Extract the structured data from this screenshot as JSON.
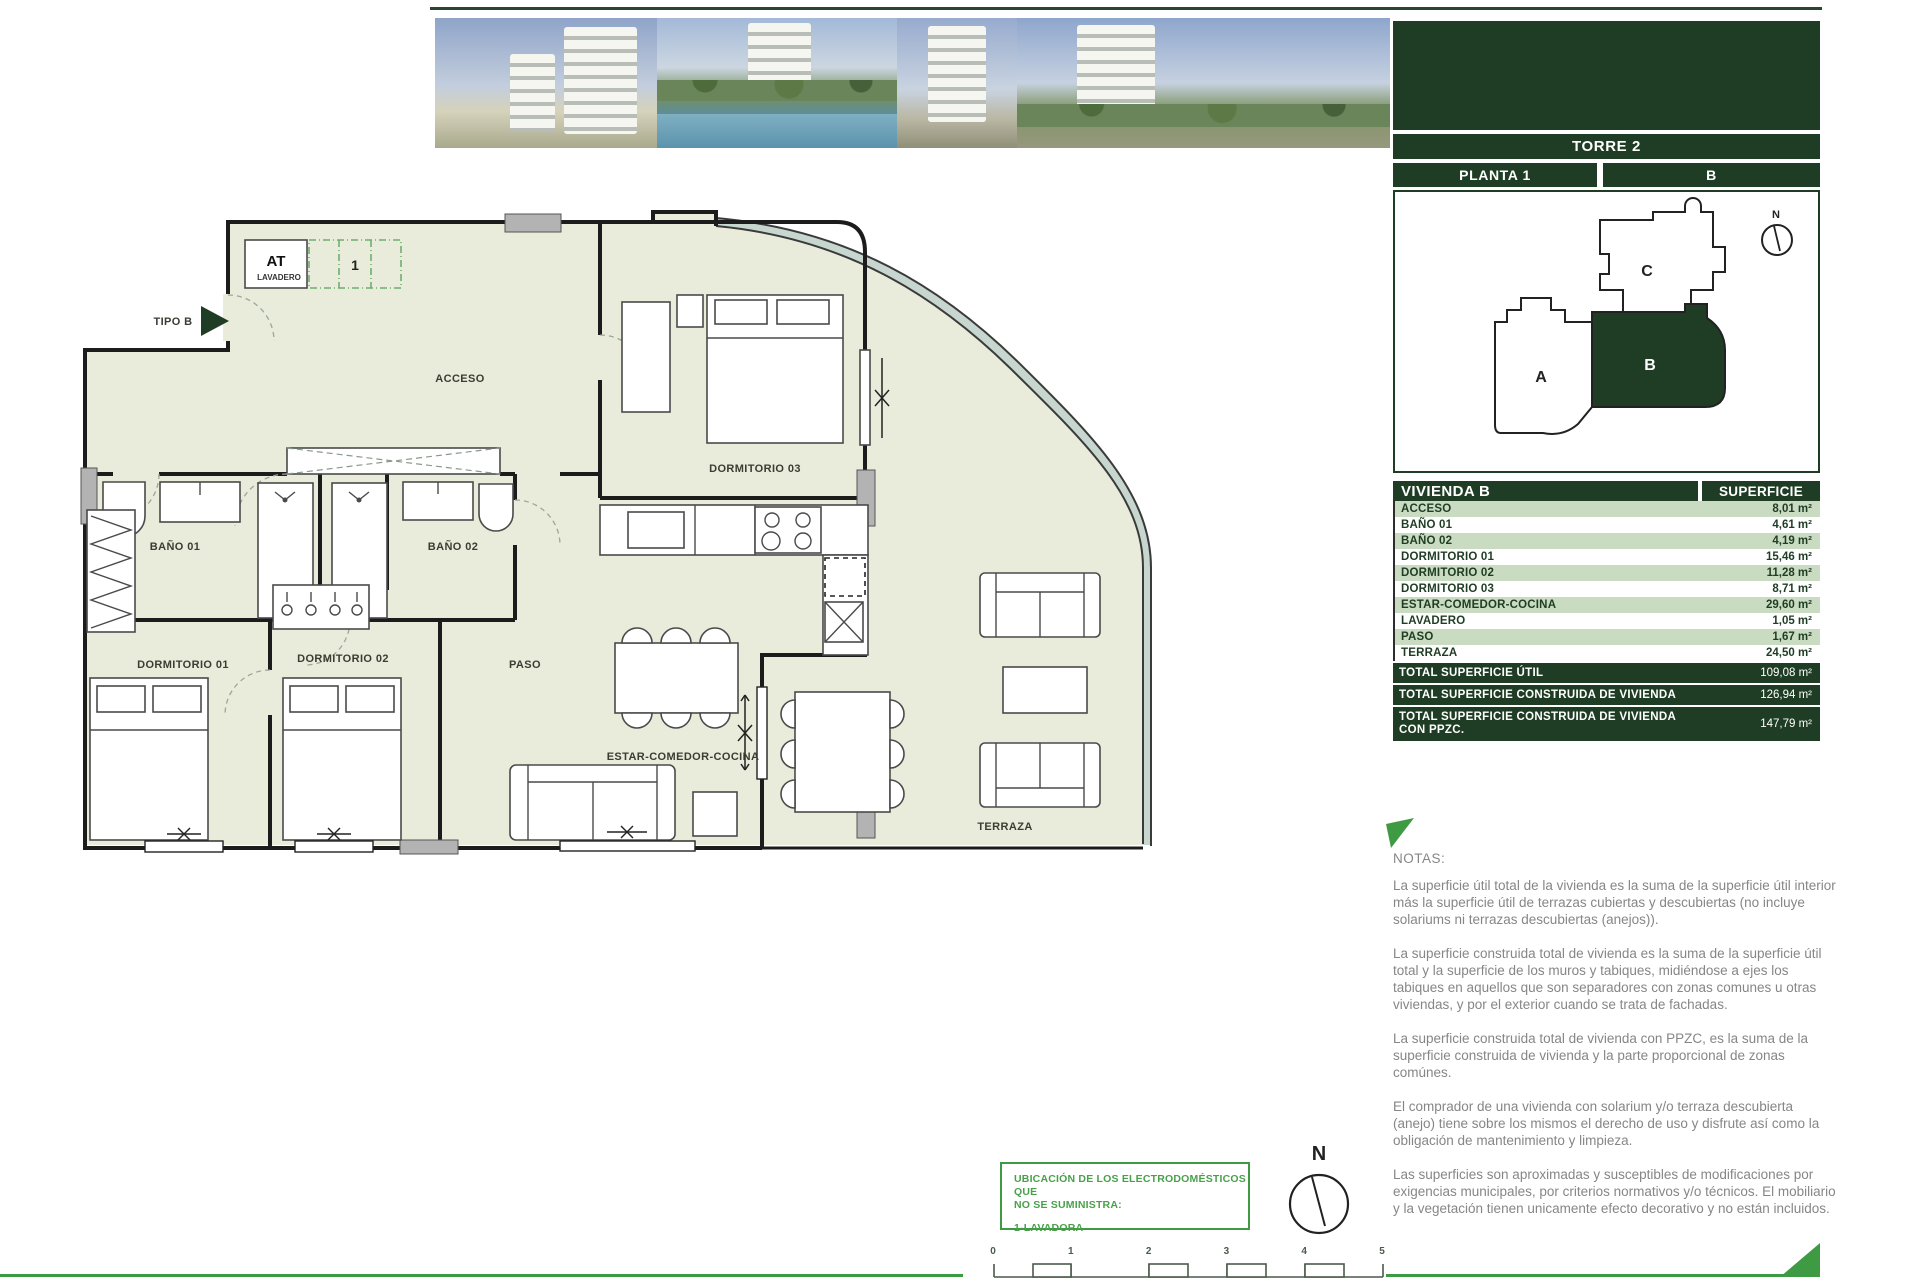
{
  "colors": {
    "dark_green": "#1f3d24",
    "row_green": "#c9dbc1",
    "accent_green": "#3f9b43",
    "floor": "#e9ecdb",
    "notes_gray": "#868686"
  },
  "header": {
    "torre": "TORRE 2",
    "planta": "PLANTA 1",
    "unit": "B"
  },
  "key_plan": {
    "unit_a": "A",
    "unit_b": "B",
    "unit_c": "C",
    "north": "N"
  },
  "area_table": {
    "title": "VIVIENDA B",
    "column": "SUPERFICIE",
    "rows": [
      {
        "label": "ACCESO",
        "value": "8,01 m²"
      },
      {
        "label": "BAÑO 01",
        "value": "4,61 m²"
      },
      {
        "label": "BAÑO 02",
        "value": "4,19 m²"
      },
      {
        "label": "DORMITORIO 01",
        "value": "15,46 m²"
      },
      {
        "label": "DORMITORIO 02",
        "value": "11,28 m²"
      },
      {
        "label": "DORMITORIO 03",
        "value": "8,71 m²"
      },
      {
        "label": "ESTAR-COMEDOR-COCINA",
        "value": "29,60 m²"
      },
      {
        "label": "LAVADERO",
        "value": "1,05 m²"
      },
      {
        "label": "PASO",
        "value": "1,67 m²"
      },
      {
        "label": "TERRAZA",
        "value": "24,50 m²"
      }
    ],
    "totals": [
      {
        "label": "TOTAL SUPERFICIE ÚTIL",
        "value": "109,08 m²",
        "lines": 1
      },
      {
        "label": "TOTAL SUPERFICIE CONSTRUIDA DE VIVIENDA",
        "value": "126,94 m²",
        "lines": 1
      },
      {
        "label": "TOTAL SUPERFICIE CONSTRUIDA DE VIVIENDA CON PPZC.",
        "value": "147,79 m²",
        "lines": 2
      }
    ]
  },
  "plan": {
    "labels": {
      "tipo": "TIPO B",
      "acceso": "ACCESO",
      "at": "AT",
      "lavadero": "LAVADERO",
      "lavadora_slot": "1",
      "dormitorio03": "DORMITORIO 03",
      "bano01": "BAÑO 01",
      "bano02": "BAÑO 02",
      "dormitorio01": "DORMITORIO 01",
      "paso": "PASO",
      "dormitorio02": "DORMITORIO 02",
      "estar": "ESTAR-COMEDOR-COCINA",
      "terraza": "TERRAZA"
    }
  },
  "legend": {
    "line1": "UBICACIÓN DE LOS ELECTRODOMÉSTICOS QUE",
    "line2": "NO SE SUMINISTRA:",
    "item": "1-LAVADORA"
  },
  "compass": {
    "north": "N"
  },
  "scale_bar": {
    "labels": [
      "0",
      "1",
      "2",
      "3",
      "4",
      "5"
    ]
  },
  "notes": {
    "heading": "NOTAS:",
    "paragraphs": [
      "La superficie útil total de la vivienda es la suma de la superficie útil interior más la superficie útil de terrazas cubiertas y descubiertas (no incluye solariums ni terrazas descubiertas (anejos)).",
      "La superficie construida total de vivienda es la suma de la superficie útil total y la superficie de los muros y tabiques, midiéndose a ejes los tabiques en aquellos que son separadores con zonas comunes u otras viviendas, y por el exterior cuando se trata de fachadas.",
      "La superficie construida total de vivienda con PPZC, es la suma de la superficie construida de vivienda y la parte proporcional de zonas comúnes.",
      "El comprador de una vivienda con solarium y/o terraza descubierta (anejo) tiene sobre los mismos el derecho de uso y disfrute así como la obligación de mantenimiento y limpieza.",
      "Las superficies son aproximadas y susceptibles de modificaciones por exigencias municipales, por criterios normativos y/o técnicos. El mobiliario y la vegetación tienen unicamente efecto decorativo y no están incluidos."
    ]
  }
}
